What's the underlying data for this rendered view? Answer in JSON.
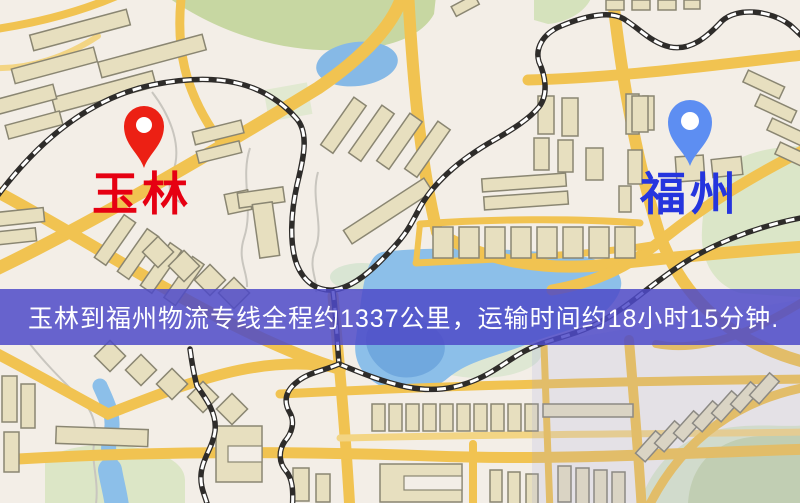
{
  "route_banner": {
    "text": "玉林到福州物流专线全程约1337公里，运输时间约18小时15分钟.",
    "distance_km": "1337",
    "transit_time": "18小时15分钟",
    "background_color": "#4d4ac8",
    "text_color": "#ffffff"
  },
  "origin": {
    "label": "玉林",
    "label_color": "#e60012",
    "pin_color": "#ec2014"
  },
  "destination": {
    "label": "福州",
    "label_color": "#2535de",
    "pin_color": "#5d8ef2"
  },
  "map_palette": {
    "background": "#f3eee7",
    "road_yellow": "#f1c351",
    "building_fill": "#e7dfbf",
    "building_outline": "#8a8672",
    "park_green": "#c9d8a6",
    "water_blue": "#8cbfe9",
    "railway_dark": "#2e2c2a",
    "railway_dash": "#ffffff"
  }
}
